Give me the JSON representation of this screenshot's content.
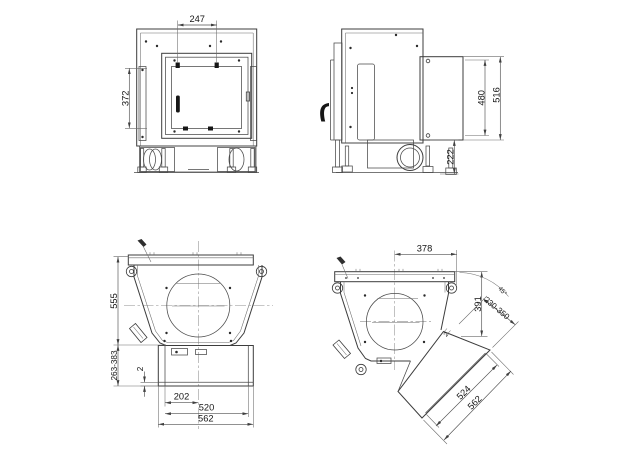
{
  "drawing": {
    "type": "technical-dimension-drawing",
    "subject": "fireplace-insert-four-views",
    "colors": {
      "line": "#3c3c3c",
      "dimension": "#4f4f4f",
      "text": "#151515",
      "background": "#ffffff"
    },
    "views": {
      "front": {
        "dims": {
          "top_width": "247",
          "door_height": "372"
        }
      },
      "side": {
        "dims": {
          "rear_inner_height": "480",
          "rear_outer_height": "516",
          "base_height": "222"
        }
      },
      "plan": {
        "dims": {
          "depth": "555",
          "extension_range": "263-383",
          "plate_gap": "2",
          "center_offset": "202",
          "inner_width": "520",
          "outer_width": "562"
        }
      },
      "plan_rotated": {
        "dims": {
          "center_offset": "378",
          "pivot_depth": "391",
          "extension_range": "230-350",
          "rotation_angle": "45°",
          "plate_gap": "2",
          "inner_width": "524",
          "outer_width": "562"
        }
      }
    }
  }
}
